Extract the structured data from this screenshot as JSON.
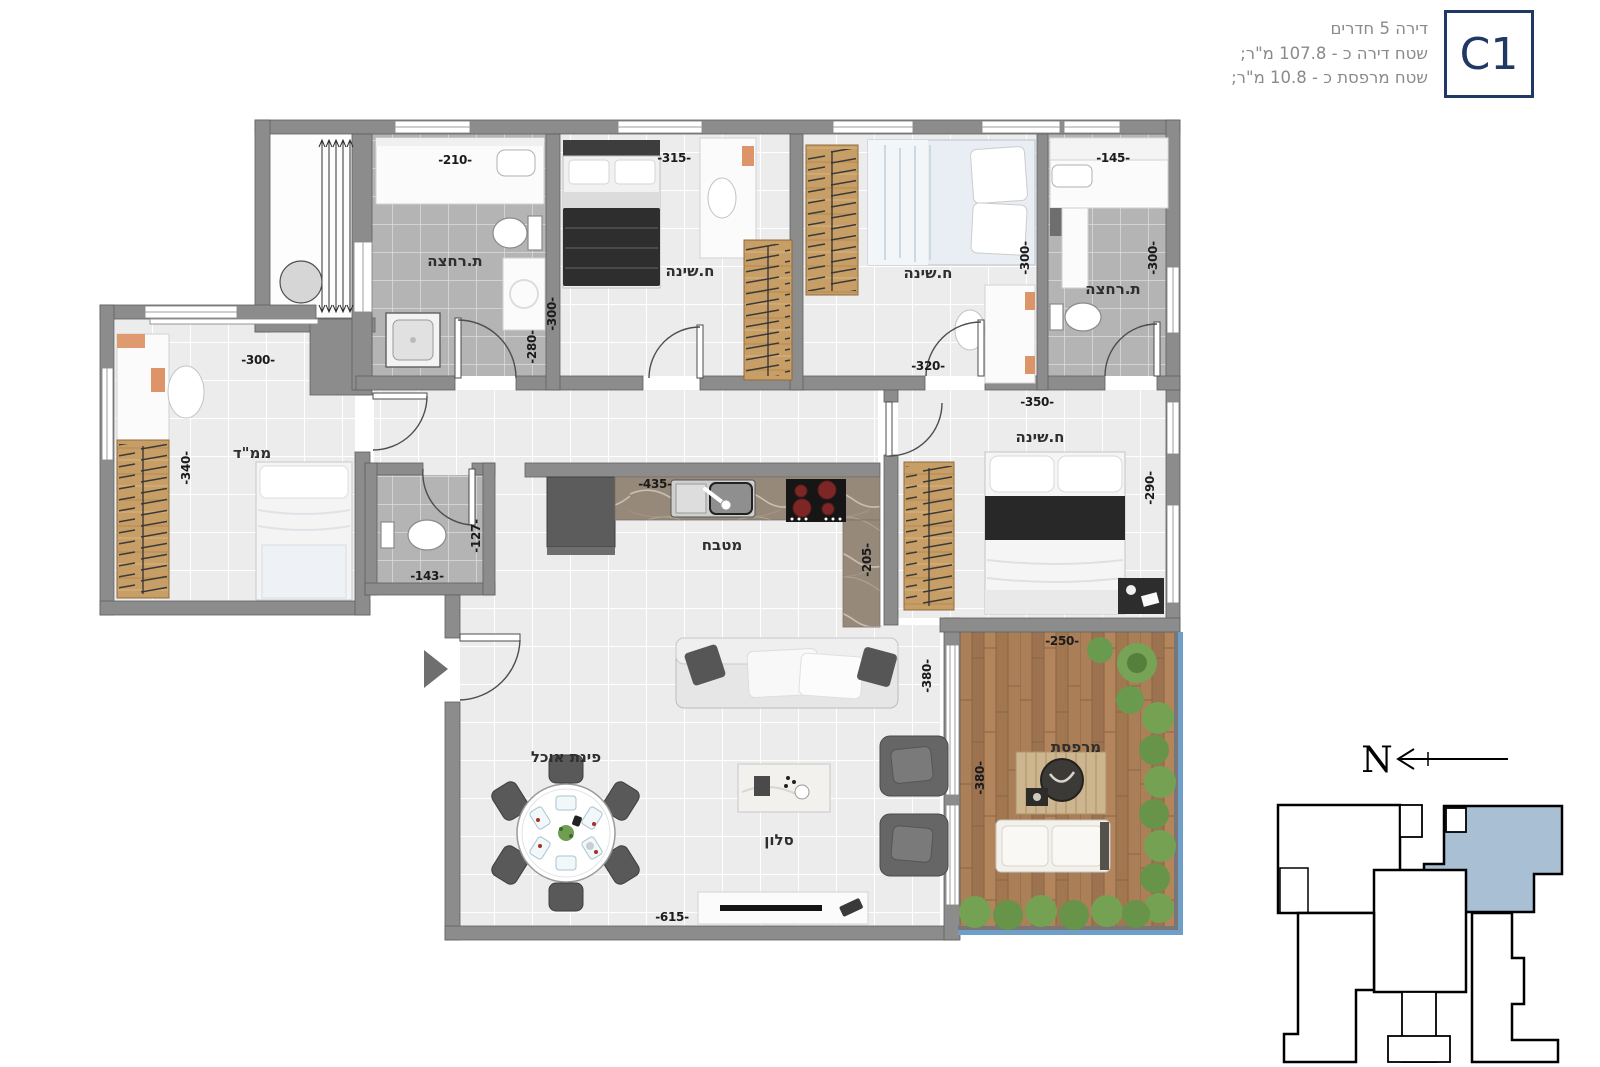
{
  "header": {
    "line1": "דירה 5 חדרים",
    "line2": "שטח דירה כ - 107.8 מ\"ר;",
    "line3": "שטח מרפסת כ - 10.8 מ\"ר;",
    "unit_code": "C1"
  },
  "rooms": {
    "bathroom_top_left": {
      "label": "ת.רחצה",
      "dim_width": "-210-",
      "dim_height": "-280-"
    },
    "bedroom_left": {
      "label": "ח.שינה",
      "dim_width": "-315-",
      "dim_height": "-300-"
    },
    "bedroom_middle": {
      "label": "ח.שינה",
      "dim_width": "-320-",
      "dim_height": "-300-"
    },
    "bathroom_top_right": {
      "label": "ת.רחצה",
      "dim_width": "-145-",
      "dim_height": "-300-"
    },
    "safe_room": {
      "label": "ממ\"ד",
      "dim_width": "-300-",
      "dim_height": "-340-"
    },
    "wc": {
      "dim_width": "-143-",
      "dim_height": "-127-"
    },
    "kitchen": {
      "label": "מטבח",
      "dim_width": "-435-",
      "dim_height": "-205-"
    },
    "master_bedroom": {
      "label": "ח.שינה",
      "dim_width": "-350-",
      "dim_height": "-290-"
    },
    "dining": {
      "label": "פינת אוכל"
    },
    "living": {
      "label": "סלון",
      "dim_width": "-615-",
      "dim_height": "-380-"
    },
    "balcony": {
      "label": "מרפסת",
      "dim_width": "-250-",
      "dim_height": "-380-"
    }
  },
  "compass": {
    "north_label": "N"
  },
  "colors": {
    "wall": "#8c8c8c",
    "unit_navy": "#1f3864",
    "key_plan_highlight": "#a9bfd4",
    "deck_wood": "#a57a52",
    "hedge_green": "#75a152",
    "railing_blue": "#6f9fc8"
  }
}
